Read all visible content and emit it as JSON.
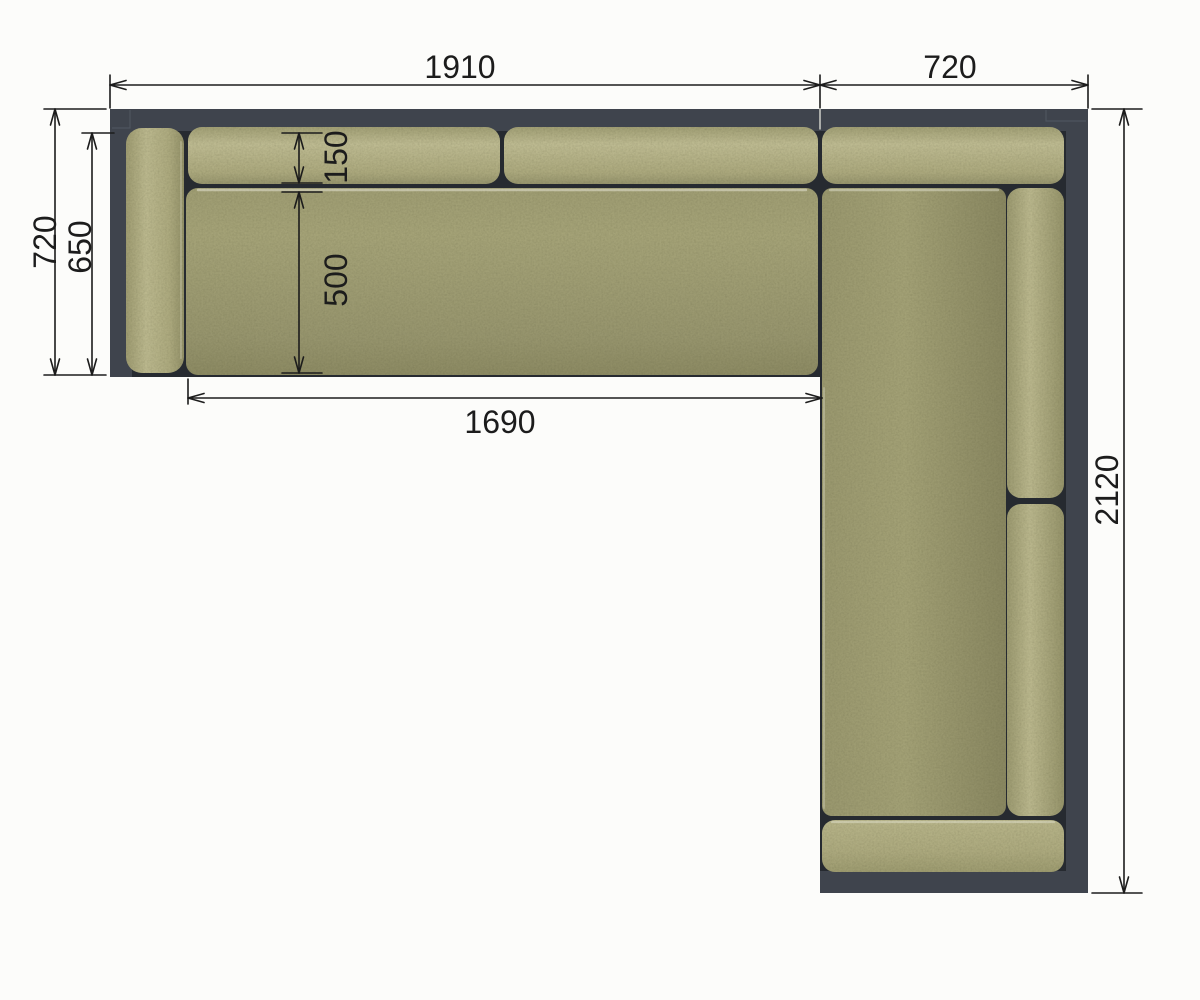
{
  "meta": {
    "type": "technical-drawing",
    "subject": "L-shaped corner sofa, top view plan with dimensions",
    "units": "mm"
  },
  "colors": {
    "background": "#fcfcfa",
    "frame": "#3f444d",
    "frame_shadow": "#262a30",
    "frame_seam": "#5a606a",
    "cushion_light": "#c2bf95",
    "cushion_mid": "#aaa87c",
    "cushion_dark": "#8f8d65",
    "dimension": "#1c1c1c",
    "extension_on_frame": "#d9dad2"
  },
  "dimensions": {
    "top_main": {
      "label": "1910"
    },
    "top_return": {
      "label": "720"
    },
    "left_depth": {
      "label": "720"
    },
    "left_arm": {
      "label": "650"
    },
    "back_cushion_depth": {
      "label": "150"
    },
    "seat_depth": {
      "label": "500"
    },
    "seat_width": {
      "label": "1690"
    },
    "right_length": {
      "label": "2120"
    }
  }
}
